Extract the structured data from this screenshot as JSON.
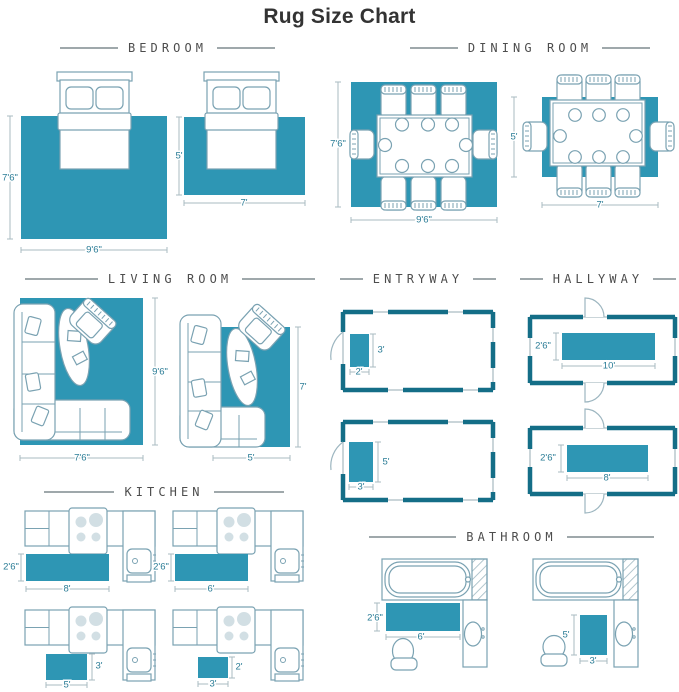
{
  "title": "Rug Size Chart",
  "colors": {
    "rug": "#2e96b4",
    "wall": "#146e87",
    "furniture_outline": "#7aa2b2",
    "dimension_text": "#2a7c96",
    "dimension_line": "#aabbc2",
    "header_text": "#4d4d4d"
  },
  "sections": {
    "bedroom": {
      "label": "BEDROOM",
      "layouts": [
        {
          "width": "9'6\"",
          "height": "7'6\""
        },
        {
          "width": "7'",
          "height": "5'"
        }
      ]
    },
    "dining_room": {
      "label": "DINING ROOM",
      "layouts": [
        {
          "width": "9'6\"",
          "height": "7'6\""
        },
        {
          "width": "7'",
          "height": "5'"
        }
      ]
    },
    "living_room": {
      "label": "LIVING ROOM",
      "layouts": [
        {
          "width": "7'6\"",
          "height": "9'6\""
        },
        {
          "width": "5'",
          "height": "7'"
        }
      ]
    },
    "entryway": {
      "label": "ENTRYWAY",
      "layouts": [
        {
          "width": "2'",
          "height": "3'"
        },
        {
          "width": "3'",
          "height": "5'"
        }
      ]
    },
    "hallway": {
      "label": "HALLYWAY",
      "layouts": [
        {
          "width": "10'",
          "height": "2'6\""
        },
        {
          "width": "8'",
          "height": "2'6\""
        }
      ]
    },
    "kitchen": {
      "label": "KITCHEN",
      "layouts": [
        {
          "width": "8'",
          "height": "2'6\""
        },
        {
          "width": "6'",
          "height": "2'6\""
        },
        {
          "width": "5'",
          "height": "3'"
        },
        {
          "width": "3'",
          "height": "2'"
        }
      ]
    },
    "bathroom": {
      "label": "BATHROOM",
      "layouts": [
        {
          "width": "6'",
          "height": "2'6\""
        },
        {
          "width": "3'",
          "height": "5'"
        }
      ]
    }
  }
}
